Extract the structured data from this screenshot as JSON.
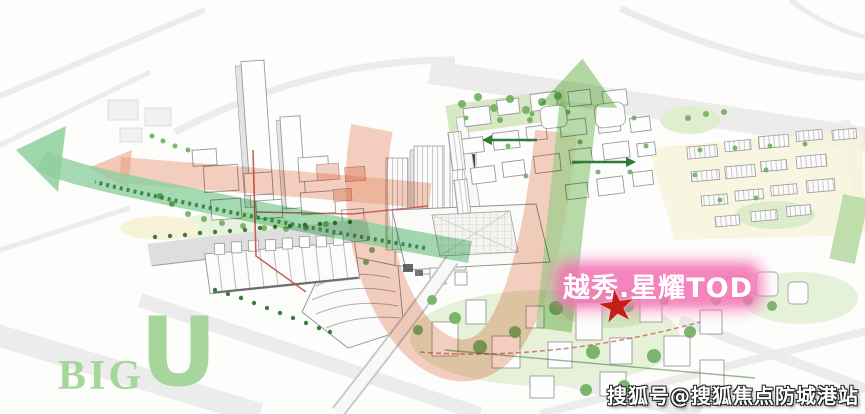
{
  "annotations": {
    "project_label": "越秀.星耀TOD",
    "star_glyph": "★",
    "big_u": {
      "big": "BIG",
      "u": "U"
    },
    "watermark": "搜狐号@搜狐焦点防城港站"
  },
  "colors": {
    "label_pink": "#f473b4",
    "label_text": "#ffffff",
    "star_red": "#c41e1a",
    "big_u_green": "#a6d69c",
    "flow_green": "#8fd2a0",
    "up_arrow_green": "#a3cf8d",
    "flow_pink": "#eb9f80",
    "arrow_dark_green": "#2f7a35",
    "tree_green": "#6fae5f",
    "rail_red": "#bf5348",
    "watermark_text": "#ffffff",
    "watermark_outline": "#222222"
  }
}
